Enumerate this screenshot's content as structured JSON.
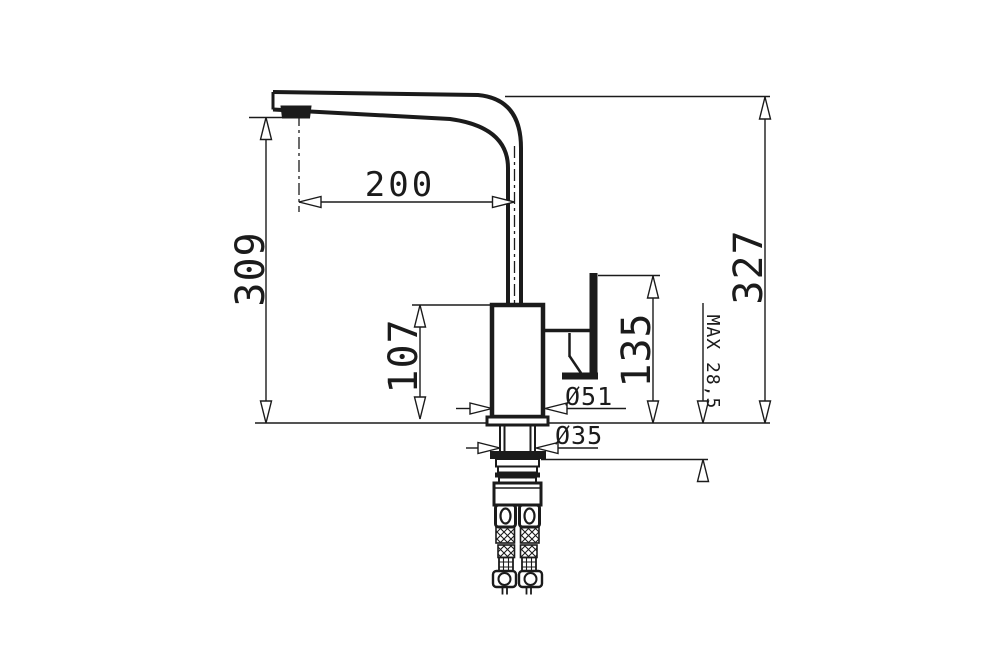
{
  "drawing": {
    "subject": "single-lever kitchen faucet side elevation with mounting hoses",
    "units_shown": "mm"
  },
  "colors": {
    "line": "#1b1b1b",
    "background": "#ffffff"
  },
  "dimensions": {
    "spout_reach": {
      "label": "200"
    },
    "spout_outlet_height": {
      "label": "309"
    },
    "total_height": {
      "label": "327"
    },
    "body_height": {
      "label": "107"
    },
    "handle_top_height": {
      "label": "135"
    },
    "max_counter_thickness": {
      "label": "MAX 28,5"
    },
    "body_diameter": {
      "label": "Ø51"
    },
    "mounting_hole_diameter": {
      "label": "Ø35"
    }
  }
}
